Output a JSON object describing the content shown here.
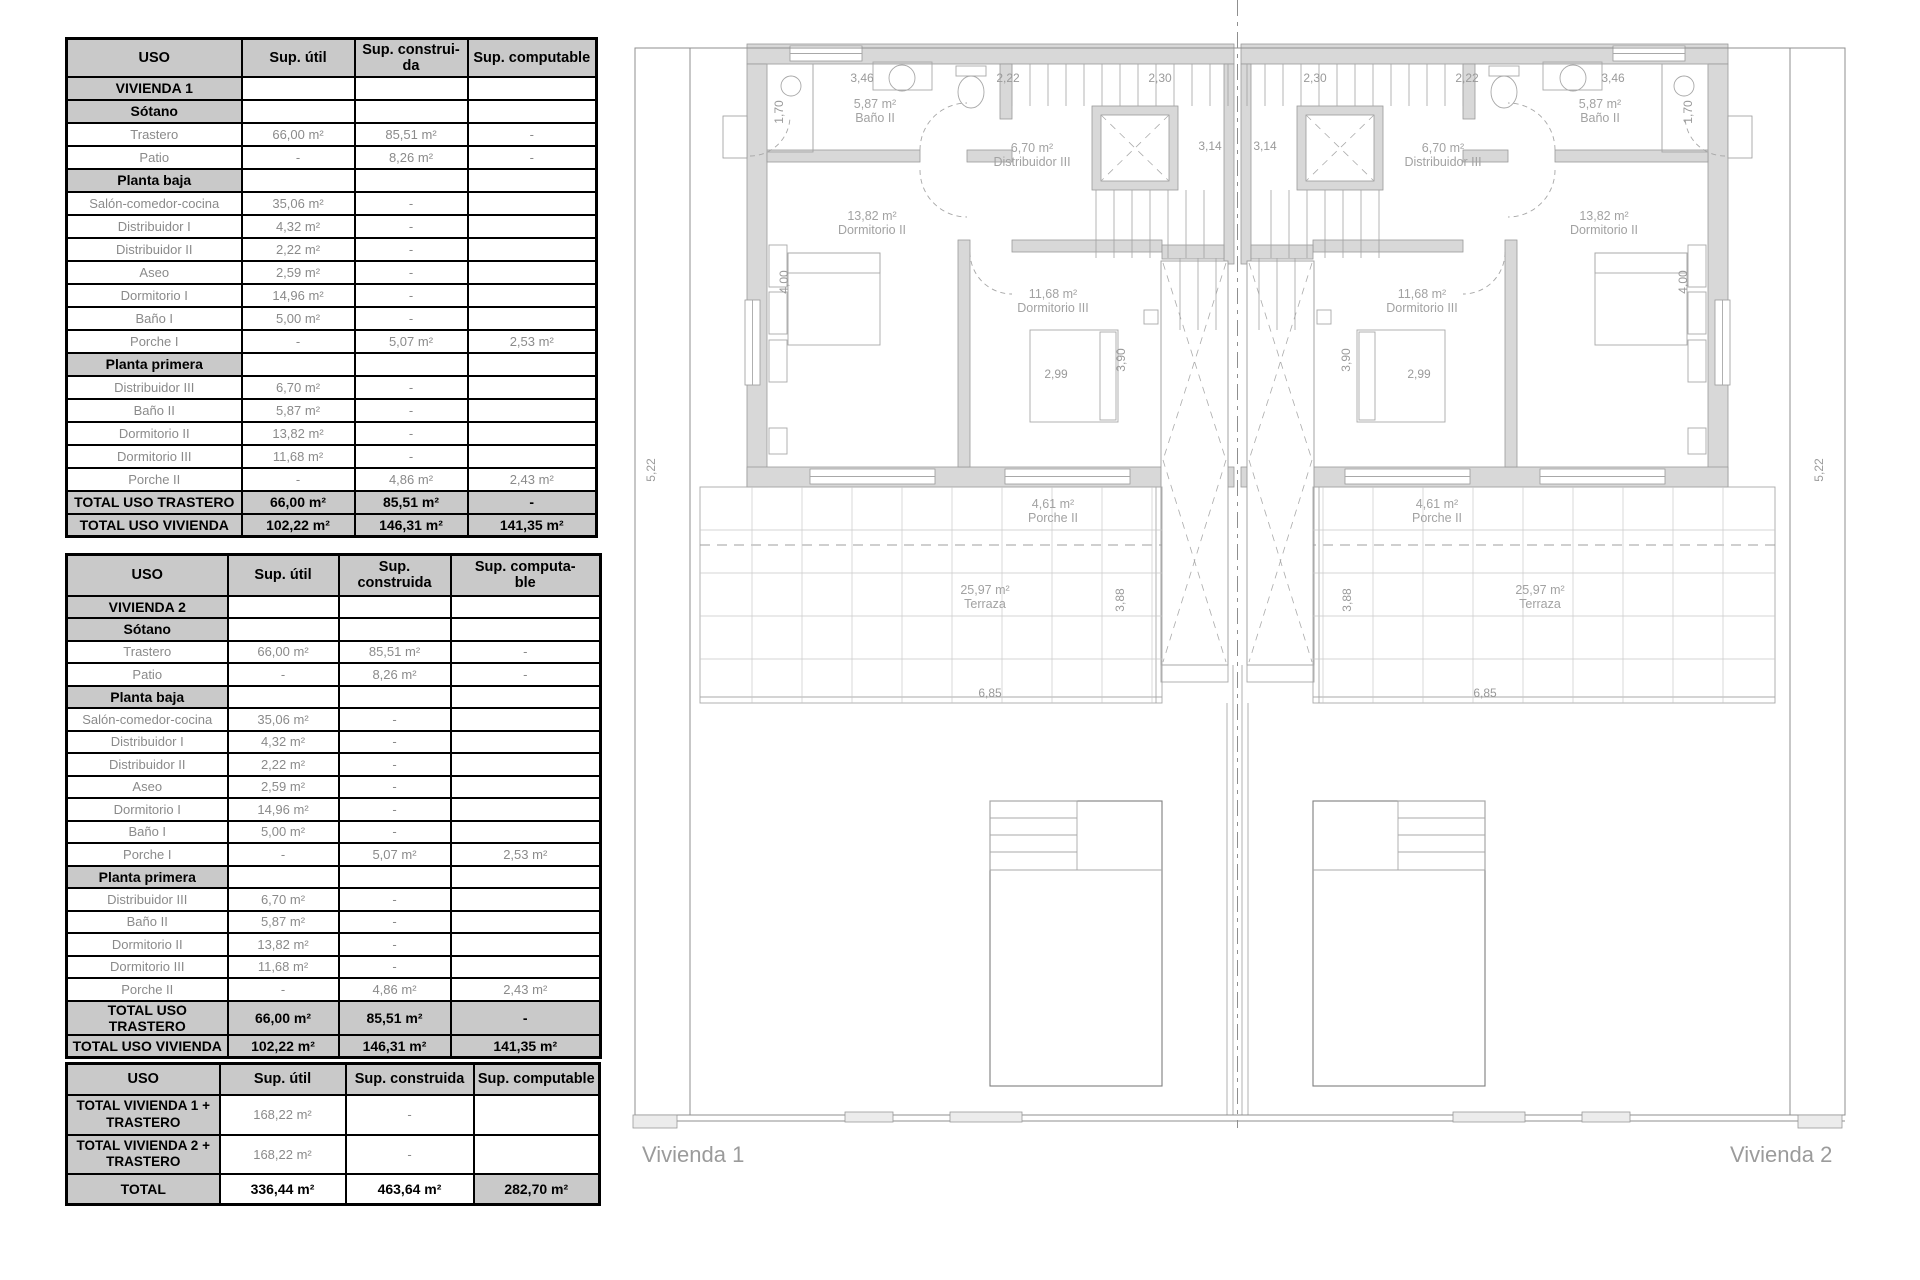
{
  "tables": [
    {
      "headers": [
        "USO",
        "Sup. útil",
        "Sup. construi-\nda",
        "Sup. computable"
      ],
      "rows": [
        {
          "type": "section",
          "label": "VIVIENDA 1",
          "util": "",
          "cons": "",
          "comp": ""
        },
        {
          "type": "section",
          "label": "Sótano",
          "util": "",
          "cons": "",
          "comp": ""
        },
        {
          "type": "data",
          "label": "Trastero",
          "util": "66,00 m²",
          "cons": "85,51 m²",
          "comp": "-"
        },
        {
          "type": "data",
          "label": "Patio",
          "util": "-",
          "cons": "8,26 m²",
          "comp": "-"
        },
        {
          "type": "section",
          "label": "Planta baja",
          "util": "",
          "cons": "",
          "comp": ""
        },
        {
          "type": "data",
          "label": "Salón-comedor-cocina",
          "util": "35,06 m²",
          "cons": "-",
          "comp": ""
        },
        {
          "type": "data",
          "label": "Distribuidor I",
          "util": "4,32 m²",
          "cons": "-",
          "comp": ""
        },
        {
          "type": "data",
          "label": "Distribuidor II",
          "util": "2,22 m²",
          "cons": "-",
          "comp": ""
        },
        {
          "type": "data",
          "label": "Aseo",
          "util": "2,59 m²",
          "cons": "-",
          "comp": ""
        },
        {
          "type": "data",
          "label": "Dormitorio I",
          "util": "14,96 m²",
          "cons": "-",
          "comp": ""
        },
        {
          "type": "data",
          "label": "Baño I",
          "util": "5,00 m²",
          "cons": "-",
          "comp": ""
        },
        {
          "type": "data",
          "label": "Porche I",
          "util": "-",
          "cons": "5,07 m²",
          "comp": "2,53 m²"
        },
        {
          "type": "section",
          "label": "Planta primera",
          "util": "",
          "cons": "",
          "comp": ""
        },
        {
          "type": "data",
          "label": "Distribuidor III",
          "util": "6,70 m²",
          "cons": "-",
          "comp": ""
        },
        {
          "type": "data",
          "label": "Baño II",
          "util": "5,87 m²",
          "cons": "-",
          "comp": ""
        },
        {
          "type": "data",
          "label": "Dormitorio II",
          "util": "13,82 m²",
          "cons": "-",
          "comp": ""
        },
        {
          "type": "data",
          "label": "Dormitorio III",
          "util": "11,68 m²",
          "cons": "-",
          "comp": ""
        },
        {
          "type": "data",
          "label": "Porche II",
          "util": "-",
          "cons": "4,86 m²",
          "comp": "2,43 m²"
        },
        {
          "type": "total",
          "label": "TOTAL USO TRASTERO",
          "util": "66,00 m²",
          "cons": "85,51 m²",
          "comp": "-"
        },
        {
          "type": "total",
          "label": "TOTAL USO VIVIENDA",
          "util": "102,22 m²",
          "cons": "146,31 m²",
          "comp": "141,35 m²"
        }
      ]
    },
    {
      "headers": [
        "USO",
        "Sup. útil",
        "Sup. construida",
        "Sup. computa-\nble"
      ],
      "rows": [
        {
          "type": "section",
          "label": "VIVIENDA 2",
          "util": "",
          "cons": "",
          "comp": ""
        },
        {
          "type": "section",
          "label": "Sótano",
          "util": "",
          "cons": "",
          "comp": ""
        },
        {
          "type": "data",
          "label": "Trastero",
          "util": "66,00 m²",
          "cons": "85,51 m²",
          "comp": "-"
        },
        {
          "type": "data",
          "label": "Patio",
          "util": "-",
          "cons": "8,26 m²",
          "comp": "-"
        },
        {
          "type": "section",
          "label": "Planta baja",
          "util": "",
          "cons": "",
          "comp": ""
        },
        {
          "type": "data",
          "label": "Salón-comedor-cocina",
          "util": "35,06 m²",
          "cons": "-",
          "comp": ""
        },
        {
          "type": "data",
          "label": "Distribuidor I",
          "util": "4,32 m²",
          "cons": "-",
          "comp": ""
        },
        {
          "type": "data",
          "label": "Distribuidor II",
          "util": "2,22 m²",
          "cons": "-",
          "comp": ""
        },
        {
          "type": "data",
          "label": "Aseo",
          "util": "2,59 m²",
          "cons": "-",
          "comp": ""
        },
        {
          "type": "data",
          "label": "Dormitorio I",
          "util": "14,96 m²",
          "cons": "-",
          "comp": ""
        },
        {
          "type": "data",
          "label": "Baño I",
          "util": "5,00 m²",
          "cons": "-",
          "comp": ""
        },
        {
          "type": "data",
          "label": "Porche I",
          "util": "-",
          "cons": "5,07 m²",
          "comp": "2,53 m²"
        },
        {
          "type": "section",
          "label": "Planta primera",
          "util": "",
          "cons": "",
          "comp": ""
        },
        {
          "type": "data",
          "label": "Distribuidor III",
          "util": "6,70 m²",
          "cons": "-",
          "comp": ""
        },
        {
          "type": "data",
          "label": "Baño II",
          "util": "5,87 m²",
          "cons": "-",
          "comp": ""
        },
        {
          "type": "data",
          "label": "Dormitorio II",
          "util": "13,82 m²",
          "cons": "-",
          "comp": ""
        },
        {
          "type": "data",
          "label": "Dormitorio III",
          "util": "11,68 m²",
          "cons": "-",
          "comp": ""
        },
        {
          "type": "data",
          "label": "Porche II",
          "util": "-",
          "cons": "4,86 m²",
          "comp": "2,43 m²"
        },
        {
          "type": "total",
          "label": "TOTAL USO TRASTERO",
          "util": "66,00 m²",
          "cons": "85,51 m²",
          "comp": "-"
        },
        {
          "type": "total",
          "label": "TOTAL USO VIVIENDA",
          "util": "102,22 m²",
          "cons": "146,31 m²",
          "comp": "141,35 m²"
        }
      ]
    },
    {
      "headers": [
        "USO",
        "Sup. útil",
        "Sup. construida",
        "Sup. computable"
      ],
      "rows": [
        {
          "type": "big",
          "label": "TOTAL VIVIENDA 1 + TRASTERO",
          "util": "168,22 m²",
          "cons": "-",
          "comp": ""
        },
        {
          "type": "big",
          "label": "TOTAL VIVIENDA 2 + TRASTERO",
          "util": "168,22 m²",
          "cons": "-",
          "comp": ""
        },
        {
          "type": "total3",
          "label": "TOTAL",
          "util": "336,44 m²",
          "cons": "463,64  m²",
          "comp": "282,70  m²"
        }
      ]
    }
  ],
  "plan": {
    "vivienda1_label": "Vivienda 1",
    "vivienda2_label": "Vivienda 2",
    "room_labels": [
      {
        "area": "5,87 m²",
        "name": "Baño II",
        "x": 875,
        "y": 108
      },
      {
        "area": "6,70 m²",
        "name": "Distribuidor III",
        "x": 1032,
        "y": 152
      },
      {
        "area": "13,82 m²",
        "name": "Dormitorio II",
        "x": 872,
        "y": 220
      },
      {
        "area": "11,68 m²",
        "name": "Dormitorio III",
        "x": 1053,
        "y": 298
      },
      {
        "area": "4,61 m²",
        "name": "Porche II",
        "x": 1053,
        "y": 508
      },
      {
        "area": "25,97 m²",
        "name": "Terraza",
        "x": 985,
        "y": 594
      },
      {
        "area": "5,87 m²",
        "name": "Baño II",
        "x": 1600,
        "y": 108
      },
      {
        "area": "6,70 m²",
        "name": "Distribuidor III",
        "x": 1443,
        "y": 152
      },
      {
        "area": "13,82 m²",
        "name": "Dormitorio II",
        "x": 1604,
        "y": 220
      },
      {
        "area": "11,68 m²",
        "name": "Dormitorio III",
        "x": 1422,
        "y": 298
      },
      {
        "area": "4,61 m²",
        "name": "Porche II",
        "x": 1437,
        "y": 508
      },
      {
        "area": "25,97 m²",
        "name": "Terraza",
        "x": 1540,
        "y": 594
      }
    ],
    "dimensions": [
      {
        "text": "1,70",
        "x": 783,
        "y": 112,
        "rot": -90
      },
      {
        "text": "3,46",
        "x": 862,
        "y": 82,
        "rot": 0
      },
      {
        "text": "2,22",
        "x": 1008,
        "y": 82,
        "rot": 0
      },
      {
        "text": "2,30",
        "x": 1160,
        "y": 82,
        "rot": 0
      },
      {
        "text": "3,14",
        "x": 1210,
        "y": 150,
        "rot": 0
      },
      {
        "text": "4,00",
        "x": 788,
        "y": 282,
        "rot": -90
      },
      {
        "text": "2,99",
        "x": 1056,
        "y": 378,
        "rot": 0
      },
      {
        "text": "3,90",
        "x": 1125,
        "y": 360,
        "rot": -90
      },
      {
        "text": "5,22",
        "x": 655,
        "y": 470,
        "rot": -90
      },
      {
        "text": "3,88",
        "x": 1124,
        "y": 600,
        "rot": -90
      },
      {
        "text": "6,85",
        "x": 990,
        "y": 697,
        "rot": 0
      },
      {
        "text": "1,70",
        "x": 1692,
        "y": 112,
        "rot": -90
      },
      {
        "text": "3,46",
        "x": 1613,
        "y": 82,
        "rot": 0
      },
      {
        "text": "2,22",
        "x": 1467,
        "y": 82,
        "rot": 0
      },
      {
        "text": "2,30",
        "x": 1315,
        "y": 82,
        "rot": 0
      },
      {
        "text": "3,14",
        "x": 1265,
        "y": 150,
        "rot": 0
      },
      {
        "text": "4,00",
        "x": 1687,
        "y": 282,
        "rot": -90
      },
      {
        "text": "2,99",
        "x": 1419,
        "y": 378,
        "rot": 0
      },
      {
        "text": "3,90",
        "x": 1350,
        "y": 360,
        "rot": -90
      },
      {
        "text": "5,22",
        "x": 1823,
        "y": 470,
        "rot": -90
      },
      {
        "text": "3,88",
        "x": 1351,
        "y": 600,
        "rot": -90
      },
      {
        "text": "6,85",
        "x": 1485,
        "y": 697,
        "rot": 0
      }
    ]
  }
}
